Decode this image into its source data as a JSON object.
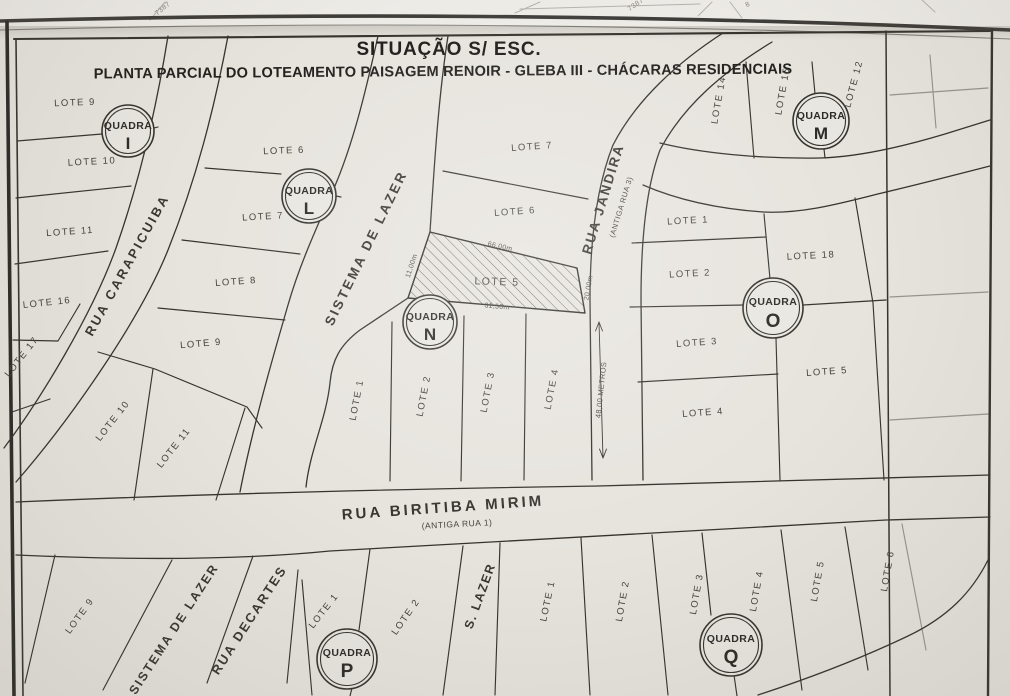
{
  "page": {
    "title": "SITUAÇÃO S/ ESC.",
    "subtitle": "PLANTA PARCIAL DO LOTEAMENTO PAISAGEM RENOIR - GLEBA III - CHÁCARAS RESIDENCIAIS"
  },
  "paper": {
    "background": "#e7e4de",
    "ink": "#35332e"
  },
  "quadras": [
    {
      "word": "QUADRA",
      "letter": "I"
    },
    {
      "word": "QUADRA",
      "letter": "L"
    },
    {
      "word": "QUADRA",
      "letter": "N"
    },
    {
      "word": "QUADRA",
      "letter": "M"
    },
    {
      "word": "QUADRA",
      "letter": "O"
    },
    {
      "word": "QUADRA",
      "letter": "P"
    },
    {
      "word": "QUADRA",
      "letter": "Q"
    }
  ],
  "streets": [
    {
      "name": "RUA CARAPICUIBA"
    },
    {
      "name": "SISTEMA DE LAZER"
    },
    {
      "name": "RUA JANDIRA",
      "alt": "(ANTIGA RUA 3)"
    },
    {
      "name": "RUA BIRITIBA MIRIM",
      "alt": "(ANTIGA RUA 1)"
    },
    {
      "name": "SISTEMA DE LAZER"
    },
    {
      "name": "RUA DECARTES"
    },
    {
      "name": "S. LAZER"
    }
  ],
  "lots": [
    {
      "text": "LOTE 9"
    },
    {
      "text": "LOTE 10"
    },
    {
      "text": "LOTE 11"
    },
    {
      "text": "LOTE 16"
    },
    {
      "text": "LOTE 17"
    },
    {
      "text": "LOTE 6"
    },
    {
      "text": "LOTE 7"
    },
    {
      "text": "LOTE 8"
    },
    {
      "text": "LOTE 9"
    },
    {
      "text": "LOTE 10"
    },
    {
      "text": "LOTE 11"
    },
    {
      "text": "LOTE 7"
    },
    {
      "text": "LOTE 6"
    },
    {
      "text": "LOTE 5"
    },
    {
      "text": "LOTE 1"
    },
    {
      "text": "LOTE 2"
    },
    {
      "text": "LOTE 3"
    },
    {
      "text": "LOTE 4"
    },
    {
      "text": "LOTE 14"
    },
    {
      "text": "LOTE 15"
    },
    {
      "text": "LOTE 12"
    },
    {
      "text": "LOTE 1"
    },
    {
      "text": "LOTE 2"
    },
    {
      "text": "LOTE 18"
    },
    {
      "text": "LOTE 3"
    },
    {
      "text": "LOTE 5"
    },
    {
      "text": "LOTE 4"
    },
    {
      "text": "LOTE 9"
    },
    {
      "text": "LOTE 1"
    },
    {
      "text": "LOTE 2"
    },
    {
      "text": "LOTE 1"
    },
    {
      "text": "LOTE 2"
    },
    {
      "text": "LOTE 3"
    },
    {
      "text": "LOTE 4"
    },
    {
      "text": "LOTE 5"
    },
    {
      "text": "LOTE 6"
    }
  ],
  "dimensions": [
    {
      "text": "66,00m"
    },
    {
      "text": "11,00m"
    },
    {
      "text": "31,50m"
    },
    {
      "text": "20,00m"
    },
    {
      "text": "48,00 METROS"
    }
  ],
  "fold_marks": [
    {
      "text": "7387"
    },
    {
      "text": "7387"
    },
    {
      "text": "8"
    }
  ]
}
